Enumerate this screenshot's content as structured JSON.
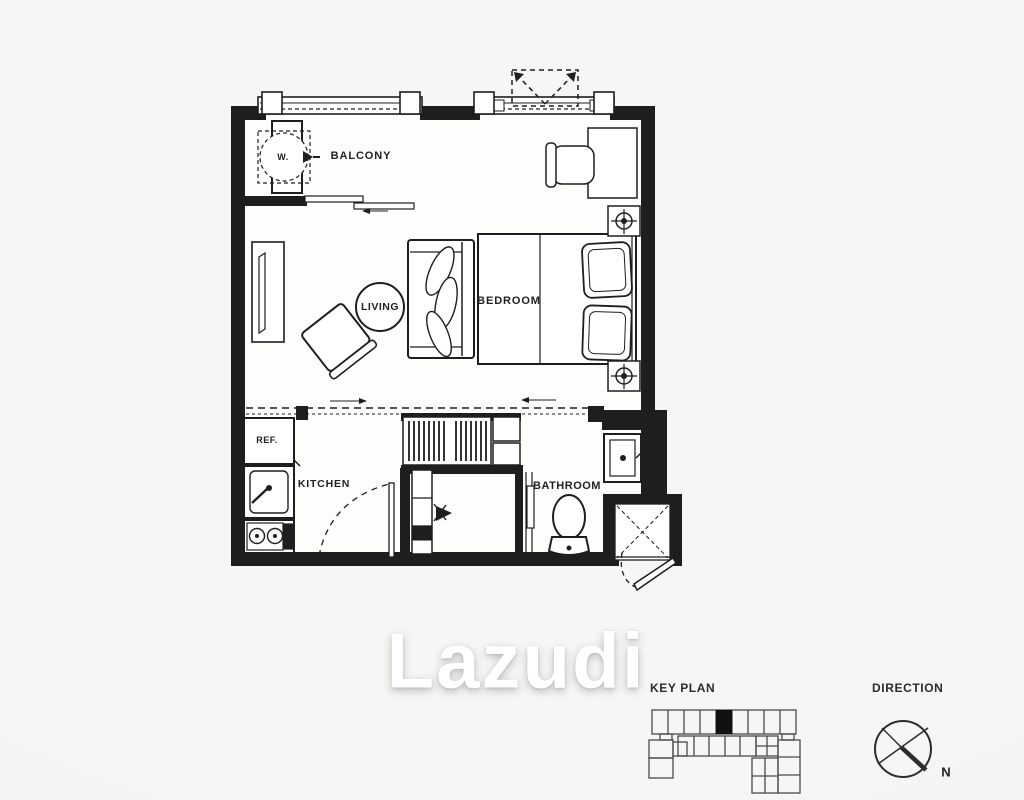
{
  "floor_plan": {
    "balcony_label": "BALCONY",
    "living_label": "LIVING",
    "bedroom_label": "BEDROOM",
    "kitchen_label": "KITCHEN",
    "bathroom_label": "BATHROOM",
    "washer_label": "W.",
    "refrigerator_label": "REF.",
    "symbols": [
      "washer",
      "balcony-sliding-door",
      "ac-unit",
      "tv-console",
      "lounge-chair",
      "coffee-table",
      "sofa",
      "double-bed",
      "pillows",
      "nightstand-lamps",
      "desk",
      "desk-chair",
      "sliding-partition",
      "wardrobe-hangers",
      "shelf",
      "refrigerator",
      "kitchen-sink",
      "stove",
      "kitchen-door",
      "shoe-cabinet",
      "bathroom-sliding-door",
      "toilet",
      "shower-basin",
      "shaft",
      "entrance-door"
    ]
  },
  "watermark": "Lazudi",
  "legend": {
    "key_plan_label": "KEY PLAN",
    "direction_label": "DIRECTION",
    "north_label": "N"
  },
  "colors": {
    "background": "#f5f5f3",
    "line": "#1e1e1e",
    "room_fill": "#fdfdfc",
    "keyplan_stroke": "#4a4a4a",
    "unit_highlight": "#111111",
    "watermark": "#ffffff"
  }
}
